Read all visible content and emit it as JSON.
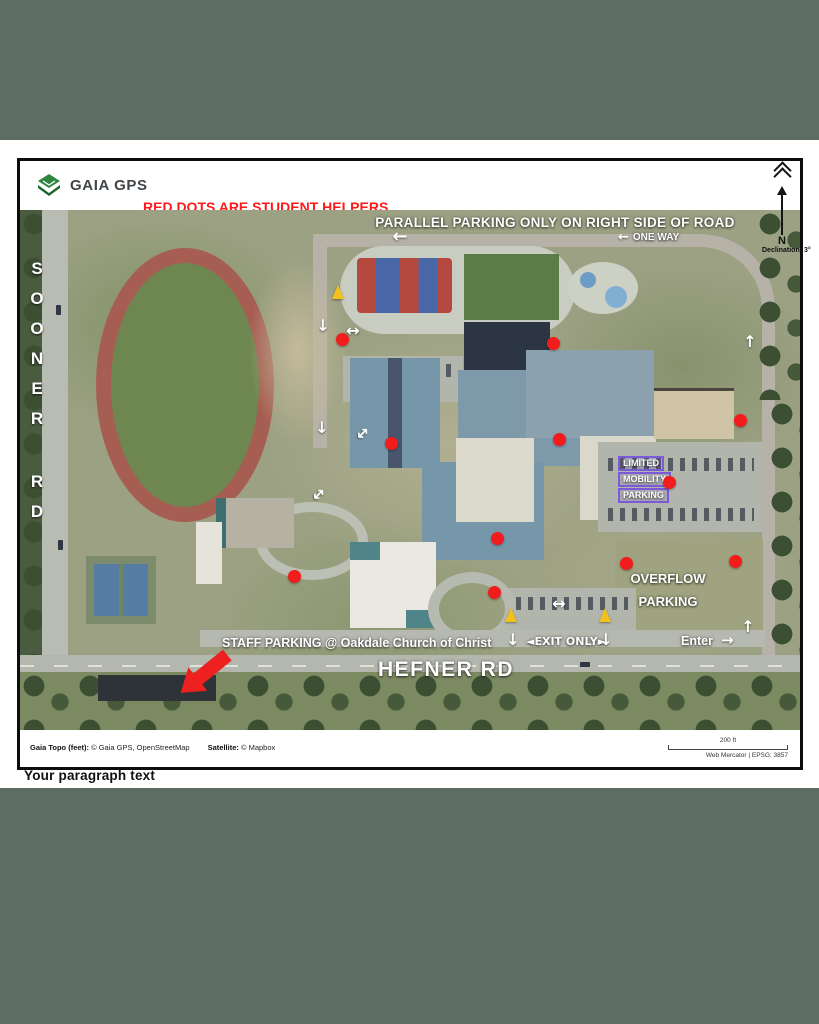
{
  "colors": {
    "canvas_green": "#5d6d63",
    "header_red": "#fe1a1a",
    "header_yellow": "#ffd337",
    "red_dot": "#f31c1c",
    "cone_yellow": "#f2c11c",
    "purple_box": "#7a5ad8"
  },
  "header": {
    "brand": "GAIA GPS",
    "line1": "RED DOTS ARE STUDENT HELPERS",
    "line2": "YELLOW  CONES ARE DO NOT ENTER SIGNS"
  },
  "north_arrow": {
    "label": "N",
    "declination": "Declination: 3°"
  },
  "map": {
    "labels": {
      "parallel_parking": "PARALLEL PARKING ONLY ON RIGHT SIDE OF ROAD",
      "one_way_arrow": "←",
      "one_way": "ONE WAY",
      "sooner_rd": "SOONER RD",
      "limited_mobility": [
        "LIMITED",
        "MOBILITY",
        "PARKING"
      ],
      "overflow": [
        "OVERFLOW",
        "PARKING"
      ],
      "staff_parking": "STAFF PARKING @ Oakdale Church of Christ",
      "exit_only": "◄EXIT ONLY►",
      "enter": "Enter",
      "enter_arrow": "→",
      "hefner_rd": "HEFNER RD"
    },
    "markers": {
      "red_dots": [
        {
          "x": 322,
          "y": 129
        },
        {
          "x": 533,
          "y": 133
        },
        {
          "x": 371,
          "y": 233
        },
        {
          "x": 539,
          "y": 229
        },
        {
          "x": 649,
          "y": 272
        },
        {
          "x": 720,
          "y": 210
        },
        {
          "x": 477,
          "y": 328
        },
        {
          "x": 274,
          "y": 366
        },
        {
          "x": 474,
          "y": 382
        },
        {
          "x": 606,
          "y": 353
        },
        {
          "x": 715,
          "y": 351
        }
      ],
      "cones": [
        {
          "x": 318,
          "y": 88
        },
        {
          "x": 491,
          "y": 411
        },
        {
          "x": 585,
          "y": 411
        }
      ],
      "arrows": [
        {
          "x": 380,
          "y": 27,
          "glyph": "←",
          "rot": 0,
          "s": 18
        },
        {
          "x": 303,
          "y": 116,
          "glyph": "↓",
          "rot": 0,
          "s": 16
        },
        {
          "x": 333,
          "y": 121,
          "glyph": "↔",
          "rot": 0,
          "s": 16
        },
        {
          "x": 302,
          "y": 218,
          "glyph": "↓",
          "rot": 0,
          "s": 16
        },
        {
          "x": 342,
          "y": 224,
          "glyph": "↕",
          "rot": 45,
          "s": 16
        },
        {
          "x": 298,
          "y": 285,
          "glyph": "↕",
          "rot": 45,
          "s": 16
        },
        {
          "x": 730,
          "y": 132,
          "glyph": "↑",
          "rot": 0,
          "s": 16
        },
        {
          "x": 539,
          "y": 394,
          "glyph": "↔",
          "rot": 0,
          "s": 16
        },
        {
          "x": 493,
          "y": 430,
          "glyph": "↓",
          "rot": 0,
          "s": 16
        },
        {
          "x": 586,
          "y": 430,
          "glyph": "↓",
          "rot": 0,
          "s": 16
        },
        {
          "x": 728,
          "y": 417,
          "glyph": "↑",
          "rot": 0,
          "s": 16
        }
      ]
    }
  },
  "footer": {
    "attr1_label": "Gaia Topo (feet):",
    "attr1_value": " © Gaia GPS, OpenStreetMap",
    "attr2_label": "Satellite:",
    "attr2_value": " © Mapbox",
    "scale_label": "200 ft",
    "projection": "Web Mercator | EPSG: 3857"
  },
  "caption": "Your paragraph text"
}
